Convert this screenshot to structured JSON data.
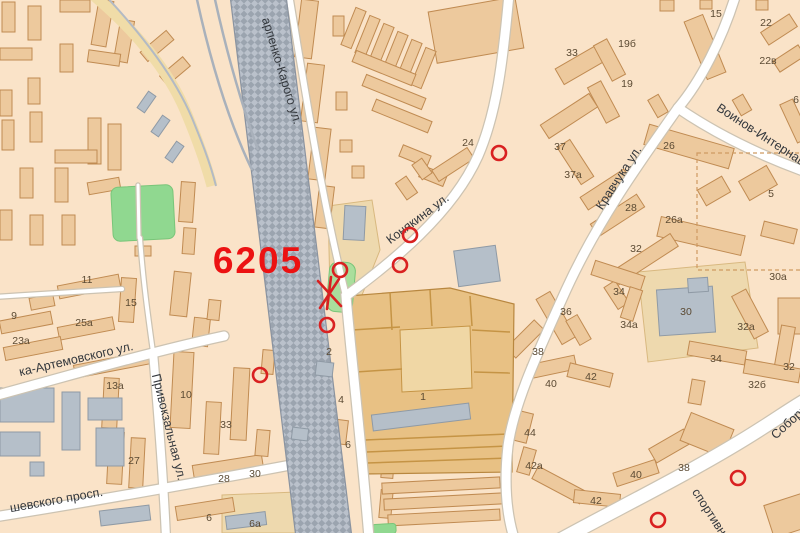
{
  "map": {
    "width": 800,
    "height": 533,
    "colors": {
      "bg": "#fae3c8",
      "building_fill": "#edc99d",
      "building_stroke": "#c08b52",
      "gray_fill": "#b5bfc9",
      "gray_stroke": "#8f9aa5",
      "plot_fill": "#eed9ae",
      "market_fill": "#e8c184",
      "market_stroke": "#b8873f",
      "market_line": "#c59445",
      "road_fill": "#ffffff",
      "road_casing": "#ccc3b2",
      "rail_dark": "#9ba4af",
      "rail_light": "#bac1cb",
      "rail_edge": "#8a93a0",
      "yellow_road": "#f0dcA8",
      "green_field": "#90d890",
      "green_side": "#aade9c",
      "street_text": "#34383d",
      "number_text": "#5b4a33",
      "marker_red": "#d92121",
      "annotation_red": "#ec1212",
      "dashed_boundary": "#cf9a62"
    },
    "annotation": {
      "t": "6205",
      "x": 258,
      "y": 273,
      "size": 37
    },
    "streets": [
      {
        "t": "арпенко-Карого ул.",
        "x": 278,
        "y": 72,
        "r": 73,
        "s": 12.5
      },
      {
        "t": "Конякина ул.",
        "x": 420,
        "y": 222,
        "r": -37,
        "s": 12.5
      },
      {
        "t": "Кравчука ул.",
        "x": 622,
        "y": 180,
        "r": -57,
        "s": 12.5
      },
      {
        "t": "Воинов-Интернаци",
        "x": 762,
        "y": 140,
        "r": 33,
        "s": 12.5
      },
      {
        "t": "ка-Артемовского ул.",
        "x": 77,
        "y": 363,
        "r": -13,
        "s": 12.5
      },
      {
        "t": "Привокзальная ул.",
        "x": 165,
        "y": 428,
        "r": 76,
        "s": 12.5
      },
      {
        "t": "шевского просп.",
        "x": 57,
        "y": 504,
        "r": -10,
        "s": 12.5
      },
      {
        "t": "Соборн",
        "x": 792,
        "y": 425,
        "r": -42,
        "s": 12.5
      },
      {
        "t": "спортивн",
        "x": 706,
        "y": 514,
        "r": 57,
        "s": 12.5
      }
    ],
    "house_numbers": [
      {
        "t": "9",
        "x": 14,
        "y": 315
      },
      {
        "t": "11",
        "x": 87,
        "y": 279
      },
      {
        "t": "15",
        "x": 131,
        "y": 302
      },
      {
        "t": "25а",
        "x": 84,
        "y": 322
      },
      {
        "t": "23а",
        "x": 21,
        "y": 340
      },
      {
        "t": "13а",
        "x": 115,
        "y": 385
      },
      {
        "t": "10",
        "x": 186,
        "y": 394
      },
      {
        "t": "33",
        "x": 226,
        "y": 424
      },
      {
        "t": "27",
        "x": 134,
        "y": 460
      },
      {
        "t": "28",
        "x": 224,
        "y": 478
      },
      {
        "t": "30",
        "x": 255,
        "y": 473
      },
      {
        "t": "6",
        "x": 209,
        "y": 517
      },
      {
        "t": "6а",
        "x": 255,
        "y": 523
      },
      {
        "t": "2",
        "x": 329,
        "y": 351
      },
      {
        "t": "4",
        "x": 341,
        "y": 399
      },
      {
        "t": "6",
        "x": 348,
        "y": 444
      },
      {
        "t": "1",
        "x": 423,
        "y": 396
      },
      {
        "t": "24",
        "x": 468,
        "y": 142
      },
      {
        "t": "33",
        "x": 572,
        "y": 52
      },
      {
        "t": "19б",
        "x": 627,
        "y": 43
      },
      {
        "t": "19",
        "x": 627,
        "y": 83
      },
      {
        "t": "15",
        "x": 716,
        "y": 13
      },
      {
        "t": "22",
        "x": 766,
        "y": 22
      },
      {
        "t": "22в",
        "x": 768,
        "y": 60
      },
      {
        "t": "6",
        "x": 796,
        "y": 99
      },
      {
        "t": "26",
        "x": 669,
        "y": 145
      },
      {
        "t": "37",
        "x": 560,
        "y": 146
      },
      {
        "t": "37а",
        "x": 573,
        "y": 174
      },
      {
        "t": "5",
        "x": 771,
        "y": 193
      },
      {
        "t": "28",
        "x": 631,
        "y": 207
      },
      {
        "t": "26а",
        "x": 674,
        "y": 219
      },
      {
        "t": "32",
        "x": 636,
        "y": 248
      },
      {
        "t": "30а",
        "x": 778,
        "y": 276
      },
      {
        "t": "34",
        "x": 619,
        "y": 291
      },
      {
        "t": "36",
        "x": 566,
        "y": 311
      },
      {
        "t": "30",
        "x": 686,
        "y": 311
      },
      {
        "t": "34а",
        "x": 629,
        "y": 324
      },
      {
        "t": "32а",
        "x": 746,
        "y": 326
      },
      {
        "t": "38",
        "x": 538,
        "y": 351
      },
      {
        "t": "34",
        "x": 716,
        "y": 358
      },
      {
        "t": "32",
        "x": 789,
        "y": 366
      },
      {
        "t": "42",
        "x": 591,
        "y": 376
      },
      {
        "t": "40",
        "x": 551,
        "y": 383
      },
      {
        "t": "32б",
        "x": 757,
        "y": 384
      },
      {
        "t": "44",
        "x": 530,
        "y": 432
      },
      {
        "t": "42а",
        "x": 534,
        "y": 465
      },
      {
        "t": "38",
        "x": 684,
        "y": 467
      },
      {
        "t": "40",
        "x": 636,
        "y": 474
      },
      {
        "t": "42",
        "x": 596,
        "y": 500
      }
    ],
    "markers": [
      [
        499,
        153
      ],
      [
        410,
        235
      ],
      [
        400,
        265
      ],
      [
        340,
        270
      ],
      [
        327,
        325
      ],
      [
        260,
        375
      ],
      [
        738,
        478
      ],
      [
        658,
        520
      ]
    ],
    "xmark": [
      [
        318,
        281,
        341,
        306
      ],
      [
        339,
        279,
        320,
        308
      ],
      [
        331,
        277,
        327,
        309
      ]
    ],
    "buildings": [
      [
        2,
        2,
        13,
        30,
        0
      ],
      [
        28,
        6,
        13,
        34,
        0
      ],
      [
        60,
        0,
        30,
        12,
        0
      ],
      [
        95,
        0,
        15,
        46,
        10
      ],
      [
        117,
        20,
        14,
        42,
        10
      ],
      [
        0,
        48,
        32,
        12,
        0
      ],
      [
        60,
        44,
        13,
        28,
        0
      ],
      [
        88,
        52,
        32,
        12,
        8
      ],
      [
        0,
        90,
        12,
        26,
        0
      ],
      [
        2,
        120,
        12,
        30,
        0
      ],
      [
        28,
        78,
        12,
        26,
        0
      ],
      [
        88,
        118,
        13,
        46,
        0
      ],
      [
        108,
        124,
        13,
        46,
        0
      ],
      [
        30,
        112,
        12,
        30,
        0
      ],
      [
        55,
        150,
        42,
        13,
        0
      ],
      [
        20,
        168,
        13,
        30,
        0
      ],
      [
        55,
        168,
        13,
        34,
        0
      ],
      [
        88,
        180,
        32,
        12,
        -10
      ],
      [
        140,
        40,
        34,
        12,
        -40
      ],
      [
        160,
        65,
        30,
        12,
        -40
      ],
      [
        180,
        182,
        14,
        40,
        4
      ],
      [
        183,
        228,
        12,
        26,
        4
      ],
      [
        135,
        246,
        16,
        10,
        0
      ],
      [
        62,
        215,
        13,
        30,
        0
      ],
      [
        30,
        215,
        13,
        30,
        0
      ],
      [
        0,
        210,
        12,
        30,
        0
      ],
      [
        172,
        272,
        17,
        44,
        6
      ],
      [
        193,
        318,
        16,
        28,
        6
      ],
      [
        208,
        300,
        12,
        20,
        6
      ],
      [
        298,
        0,
        17,
        58,
        7
      ],
      [
        304,
        64,
        17,
        58,
        7
      ],
      [
        311,
        128,
        17,
        52,
        7
      ],
      [
        317,
        186,
        15,
        42,
        7
      ],
      [
        333,
        16,
        11,
        20,
        0
      ],
      [
        336,
        92,
        11,
        18,
        0
      ],
      [
        432,
        4,
        88,
        52,
        -10
      ],
      [
        348,
        8,
        11,
        40,
        22
      ],
      [
        362,
        16,
        11,
        40,
        22
      ],
      [
        376,
        24,
        11,
        40,
        22
      ],
      [
        390,
        32,
        11,
        40,
        22
      ],
      [
        404,
        40,
        11,
        40,
        22
      ],
      [
        418,
        48,
        11,
        40,
        22
      ],
      [
        352,
        62,
        64,
        12,
        22
      ],
      [
        362,
        86,
        64,
        12,
        22
      ],
      [
        372,
        110,
        60,
        12,
        22
      ],
      [
        340,
        140,
        12,
        12,
        0
      ],
      [
        352,
        166,
        12,
        12,
        0
      ],
      [
        400,
        150,
        30,
        12,
        22
      ],
      [
        420,
        170,
        26,
        12,
        22
      ],
      [
        432,
        158,
        42,
        13,
        -33
      ],
      [
        400,
        178,
        13,
        20,
        -35
      ],
      [
        416,
        160,
        12,
        18,
        -35
      ],
      [
        556,
        54,
        55,
        18,
        -30
      ],
      [
        602,
        40,
        15,
        40,
        -28
      ],
      [
        596,
        82,
        15,
        40,
        -28
      ],
      [
        695,
        16,
        20,
        62,
        -22
      ],
      [
        762,
        22,
        34,
        15,
        -33
      ],
      [
        774,
        52,
        30,
        13,
        -33
      ],
      [
        788,
        100,
        14,
        42,
        -25
      ],
      [
        645,
        136,
        88,
        21,
        16
      ],
      [
        540,
        108,
        58,
        16,
        -33
      ],
      [
        568,
        140,
        15,
        44,
        -33
      ],
      [
        580,
        182,
        52,
        15,
        -33
      ],
      [
        742,
        172,
        32,
        22,
        -30
      ],
      [
        700,
        182,
        28,
        18,
        -30
      ],
      [
        590,
        208,
        55,
        15,
        -33
      ],
      [
        658,
        226,
        86,
        20,
        13
      ],
      [
        608,
        252,
        72,
        15,
        -33
      ],
      [
        610,
        282,
        13,
        26,
        -33
      ],
      [
        742,
        290,
        16,
        48,
        -28
      ],
      [
        762,
        225,
        34,
        15,
        14
      ],
      [
        778,
        298,
        26,
        36,
        0
      ],
      [
        592,
        268,
        52,
        15,
        18
      ],
      [
        625,
        288,
        13,
        32,
        18
      ],
      [
        548,
        292,
        16,
        52,
        -30
      ],
      [
        572,
        316,
        13,
        28,
        -30
      ],
      [
        505,
        332,
        40,
        14,
        -45
      ],
      [
        528,
        360,
        48,
        14,
        -12
      ],
      [
        568,
        368,
        44,
        14,
        14
      ],
      [
        688,
        346,
        58,
        14,
        10
      ],
      [
        744,
        364,
        56,
        14,
        10
      ],
      [
        778,
        326,
        14,
        40,
        10
      ],
      [
        690,
        380,
        13,
        24,
        10
      ],
      [
        516,
        412,
        14,
        30,
        14
      ],
      [
        520,
        448,
        13,
        26,
        16
      ],
      [
        532,
        478,
        54,
        14,
        28
      ],
      [
        574,
        492,
        46,
        13,
        6
      ],
      [
        614,
        466,
        44,
        14,
        -18
      ],
      [
        650,
        438,
        40,
        16,
        -30
      ],
      [
        684,
        420,
        46,
        30,
        22
      ],
      [
        768,
        498,
        44,
        34,
        -18
      ],
      [
        660,
        0,
        14,
        11,
        0
      ],
      [
        700,
        0,
        12,
        9,
        0
      ],
      [
        756,
        0,
        12,
        10,
        0
      ],
      [
        736,
        96,
        12,
        18,
        -30
      ],
      [
        652,
        96,
        12,
        20,
        -30
      ],
      [
        0,
        316,
        52,
        13,
        -11
      ],
      [
        58,
        280,
        62,
        13,
        -11
      ],
      [
        58,
        322,
        56,
        13,
        -11
      ],
      [
        4,
        342,
        58,
        13,
        -11
      ],
      [
        120,
        278,
        15,
        44,
        4
      ],
      [
        30,
        296,
        24,
        12,
        -11
      ],
      [
        74,
        358,
        76,
        13,
        -11
      ],
      [
        103,
        378,
        15,
        50,
        3
      ],
      [
        172,
        352,
        20,
        76,
        3
      ],
      [
        205,
        402,
        15,
        52,
        3
      ],
      [
        232,
        368,
        16,
        72,
        3
      ],
      [
        130,
        438,
        14,
        50,
        3
      ],
      [
        108,
        432,
        15,
        52,
        3
      ],
      [
        193,
        460,
        70,
        15,
        -9
      ],
      [
        176,
        502,
        58,
        14,
        -9
      ],
      [
        256,
        430,
        13,
        26,
        5
      ],
      [
        262,
        350,
        12,
        24,
        5
      ],
      [
        382,
        450,
        12,
        28,
        5
      ],
      [
        380,
        490,
        12,
        28,
        5
      ],
      [
        335,
        420,
        12,
        24,
        7
      ],
      [
        382,
        480,
        118,
        11,
        -3
      ],
      [
        384,
        496,
        118,
        11,
        -3
      ],
      [
        388,
        512,
        112,
        11,
        -3
      ]
    ],
    "gray_buildings": [
      [
        344,
        206,
        21,
        34,
        3
      ],
      [
        456,
        248,
        42,
        36,
        -8
      ],
      [
        372,
        409,
        98,
        16,
        -7
      ],
      [
        658,
        288,
        56,
        46,
        -4
      ],
      [
        688,
        278,
        20,
        14,
        -4
      ],
      [
        226,
        514,
        40,
        13,
        -7
      ],
      [
        0,
        388,
        54,
        34,
        0
      ],
      [
        62,
        392,
        18,
        58,
        0
      ],
      [
        88,
        398,
        34,
        22,
        0
      ],
      [
        0,
        432,
        40,
        24,
        0
      ],
      [
        96,
        428,
        28,
        38,
        0
      ],
      [
        100,
        508,
        50,
        15,
        -7
      ],
      [
        30,
        462,
        14,
        14,
        0
      ]
    ],
    "platforms": [
      [
        316,
        362,
        17,
        14,
        7
      ],
      [
        292,
        428,
        16,
        12,
        7
      ],
      [
        142,
        92,
        9,
        20,
        35
      ],
      [
        156,
        116,
        9,
        20,
        35
      ],
      [
        170,
        142,
        9,
        20,
        35
      ]
    ],
    "plots": [
      "M328,206 L372,200 L380,250 L360,300 L330,292 Z",
      "M638,272 L745,262 L758,348 L648,362 Z",
      "M222,495 L296,492 L298,533 L222,533 Z"
    ],
    "market": {
      "outline": "M348,296 L450,288 L514,304 L512,472 L364,474 Z",
      "court": "M400,330 L470,326 L472,388 L402,392 Z",
      "lines": [
        "M390,292 L392,330",
        "M430,290 L432,326",
        "M470,296 L472,326",
        "M352,330 L400,327",
        "M472,330 L510,332",
        "M356,372 L402,369",
        "M474,372 L510,373",
        "M365,440 L508,434",
        "M366,452 L508,446",
        "M367,463 L509,458"
      ]
    },
    "railway": {
      "band": "230,-5 286,-5 352,538 296,538",
      "tracks": [
        "M196,-5 C210,60 228,120 252,170",
        "M214,-5 C226,50 240,100 258,150"
      ],
      "yellow": "M92,-6 C135,30 168,70 185,110 C196,136 205,160 212,186",
      "yellow_rail": "M104,-6 C145,38 175,78 192,118 C201,140 210,162 216,186"
    },
    "roads": [
      {
        "d": "M509,-6 C503,60 497,112 478,156 C452,214 392,262 346,296 C350,345 360,430 369,538",
        "w": 9
      },
      {
        "d": "M289,-6 C305,90 322,200 346,296",
        "w": 6
      },
      {
        "d": "M736,-6 C722,40 700,82 678,108",
        "w": 9
      },
      {
        "d": "M678,108 C716,134 762,156 806,172",
        "w": 9
      },
      {
        "d": "M678,108 C640,162 598,220 566,290 C540,348 514,402 508,446 C504,482 506,512 514,538",
        "w": 9
      },
      {
        "d": "M560,540 C622,506 700,468 762,428 C778,418 792,408 806,400",
        "w": 13
      },
      {
        "d": "M-6,396 C60,378 150,352 224,336",
        "w": 9
      },
      {
        "d": "M153,352 C158,410 163,470 166,538",
        "w": 8
      },
      {
        "d": "M-6,517 C90,502 200,482 296,464",
        "w": 9
      },
      {
        "d": "M140,238 C143,280 148,316 153,352",
        "w": 4
      },
      {
        "d": "M-6,297 C40,294 90,291 122,289",
        "w": 4
      },
      {
        "d": "M138,185 L139,238",
        "w": 3
      }
    ],
    "greens": [
      {
        "x": 112,
        "y": 186,
        "w": 62,
        "h": 54,
        "r": -3,
        "rx": 7,
        "c": "green_field"
      },
      {
        "x": 328,
        "y": 262,
        "w": 26,
        "h": 50,
        "r": 5,
        "rx": 9,
        "c": "green_side"
      },
      {
        "x": 372,
        "y": 524,
        "w": 24,
        "h": 10,
        "r": -3,
        "rx": 3,
        "c": "green_field"
      }
    ],
    "dashed_boundary": {
      "x": 697,
      "y": 153,
      "w": 105,
      "h": 117
    }
  }
}
